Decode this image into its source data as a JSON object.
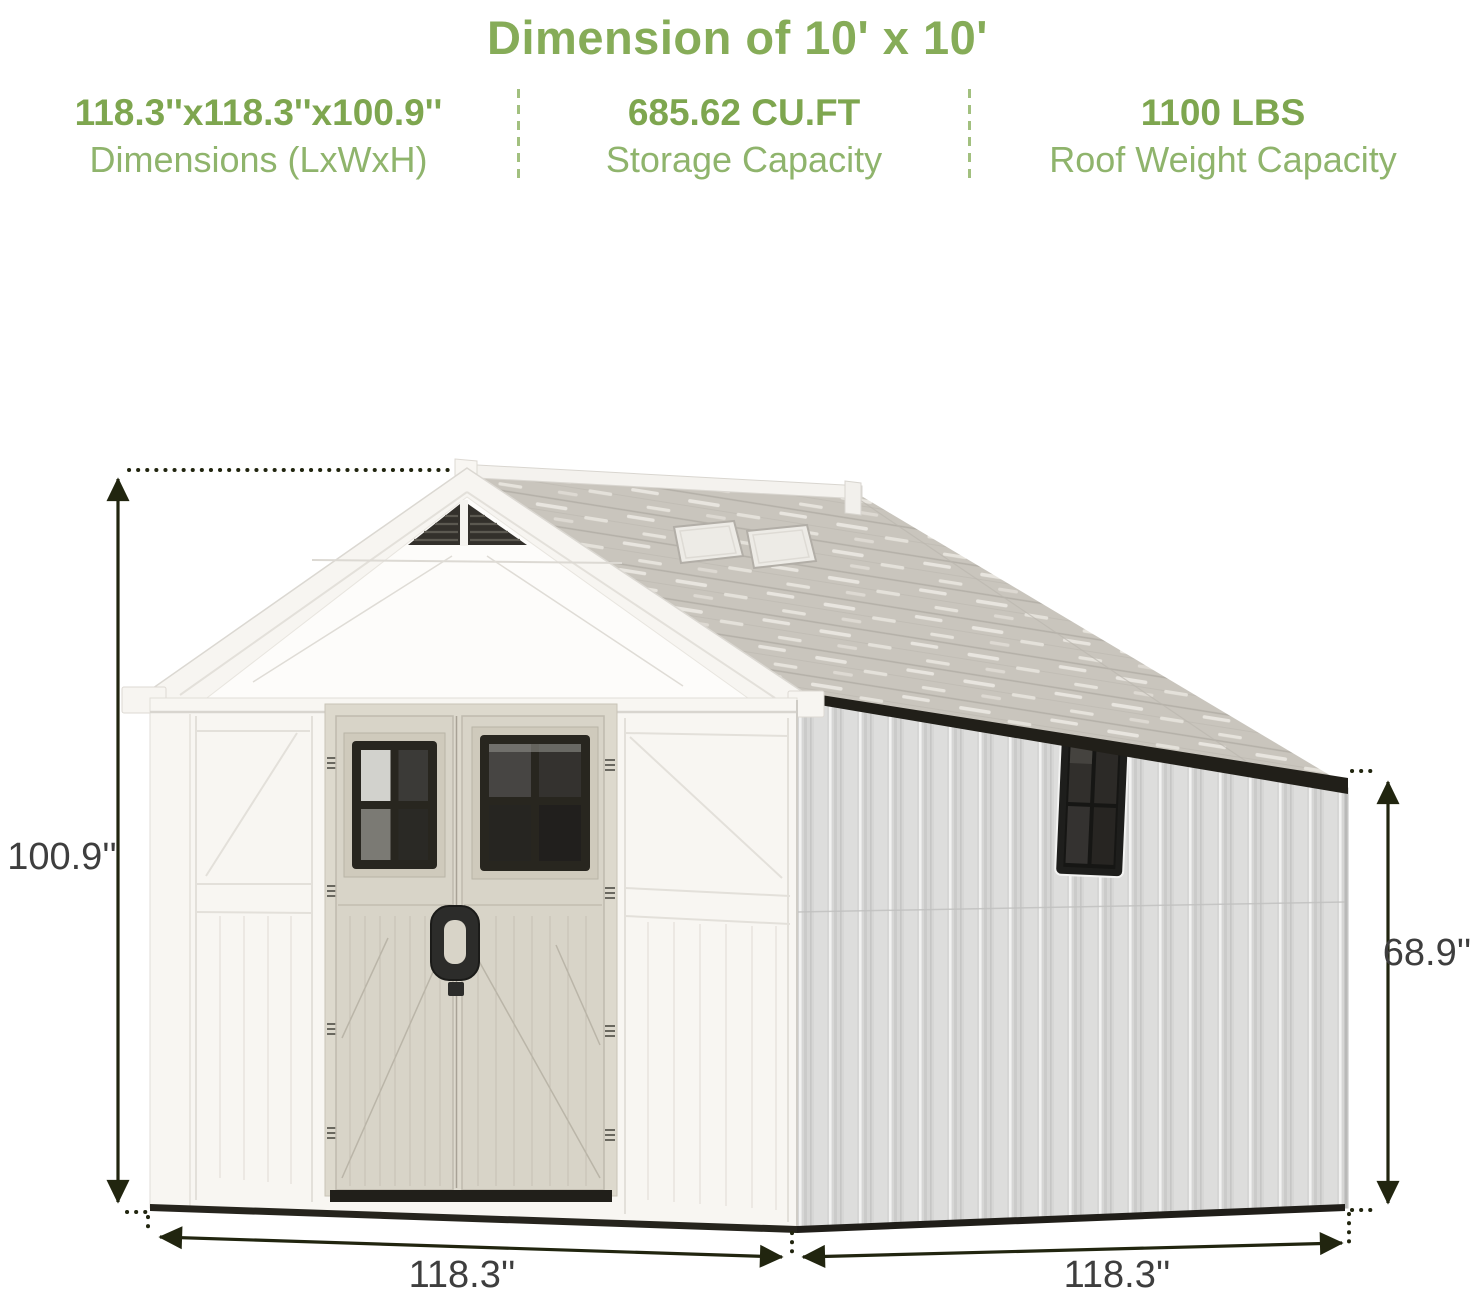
{
  "header": {
    "title": "Dimension of 10' x 10'"
  },
  "specs": [
    {
      "value": "118.3''x118.3''x100.9''",
      "label": "Dimensions (LxWxH)"
    },
    {
      "value": "685.62 CU.FT",
      "label": "Storage Capacity"
    },
    {
      "value": "1100 LBS",
      "label": "Roof Weight Capacity"
    }
  ],
  "figure": {
    "labels": {
      "front_height": "100.9''",
      "side_height": "68.9''",
      "front_width": "118.3''",
      "side_width": "118.3''"
    }
  },
  "colors": {
    "accent_green": "#86ac58",
    "sub_green": "#8fb46c",
    "dimension_text": "#3e3e3e",
    "dimension_line": "#21250f"
  }
}
